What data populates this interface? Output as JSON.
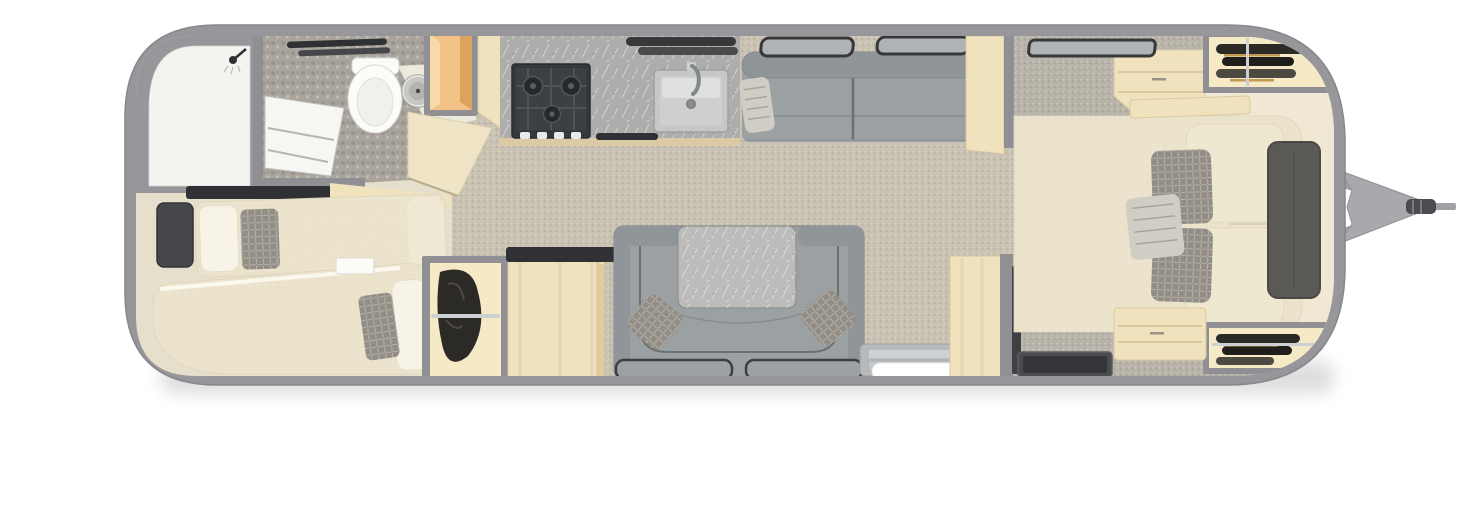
{
  "page": {
    "background": "#ffffff"
  },
  "floorplan": {
    "type": "travel-trailer-top-view",
    "areas": [
      "bathroom",
      "twin-bedroom",
      "galley-kitchen",
      "lounge",
      "u-dinette",
      "entry",
      "main-bedroom",
      "hitch-tongue"
    ],
    "items": [
      "shower",
      "shower-door",
      "towel-bars",
      "toilet",
      "round-sink",
      "bathroom-cabinet",
      "vanity-cabinet",
      "angled-partition",
      "twin-bed-upper",
      "twin-bed-lower",
      "nightstand-dark",
      "nightstand-white",
      "twin-wardrobe",
      "refrigerator-cabinet",
      "kitchen-counter",
      "stove",
      "kitchen-sink",
      "galley-window-slats",
      "sofa",
      "sofa-windows",
      "sofa-side-table",
      "dinette-table",
      "dinette-pillows",
      "floor-mats",
      "entry-steps",
      "entry-partition",
      "tv",
      "queen-bed",
      "bed-pillows",
      "headboard",
      "bedroom-dresser",
      "bedroom-window",
      "wardrobe-curb-side",
      "wardrobe-road-side",
      "foot-bench",
      "a-frame-hitch",
      "hitch-coupler"
    ]
  },
  "colors": {
    "shell": "#97979b",
    "shellEdge": "#86868b",
    "wallGray": "#8f8f94",
    "floorVinyl": "#e6dfcb",
    "carpetMain": "#c9c2b2",
    "carpetBedroom": "#b8b3a9",
    "pebble": "#a9a59d",
    "showerWhite": "#f3f3f0",
    "doorWhite": "#f6f6f3",
    "woodOrange": "#f2c286",
    "woodOrangeShade": "#dca35c",
    "woodCream": "#f0e2bc",
    "woodGrain": "#d9c8a2",
    "woodPartition": "#efe4c6",
    "wardrobeCream": "#f6e9c6",
    "glowCream": "#f0e8d2",
    "counterMarble": "#adadab",
    "counterEdge": "#dbcaa4",
    "stoveBody": "#35383c",
    "stoveGrate": "#3c4044",
    "burner": "#26282b",
    "burnerRing": "#53565b",
    "sinkRim": "#c6c7c7",
    "sinkBasin": "#ced0d0",
    "faucet": "#85888b",
    "windowFrame": "#37383a",
    "windowGlass": "#aeb3b5",
    "sofaSeat": "#9ba1a3",
    "sofaBack": "#8f9598",
    "sofaSeam": "#6a7073",
    "tableMarble": "#bcbcba",
    "matGray": "#9ea1a3",
    "matEdge": "#3c3e40",
    "stepGray": "#b7babc",
    "stepTread": "#ced1d3",
    "stepWhite": "#ffffff",
    "bedCream": "#ebe3cb",
    "bedEdge": "#ddd5bc",
    "pillowWhite": "#f7f3e7",
    "pillowCream": "#efe8d0",
    "pillowGray": "#938e85",
    "pillowSilver": "#d0cdc5",
    "darkCharcoal": "#303134",
    "darkSoft": "#46474a",
    "clothes": "#2b2a26",
    "clothesLight": "#4c4a40",
    "hangerGold": "#c09a52",
    "silver": "#cdd0d3",
    "headboard": "#5b5956",
    "headboardEdge": "#4a4845",
    "tvPanel": "#4a4b4e",
    "tvScreen": "#343539",
    "hitchBar": "#9fa1a5",
    "hitchPlate": "#a7a9ac",
    "hitchDark": "#4b4c4f",
    "toiletWhite": "#fbfbf8",
    "shadow": "#9a9a98"
  }
}
